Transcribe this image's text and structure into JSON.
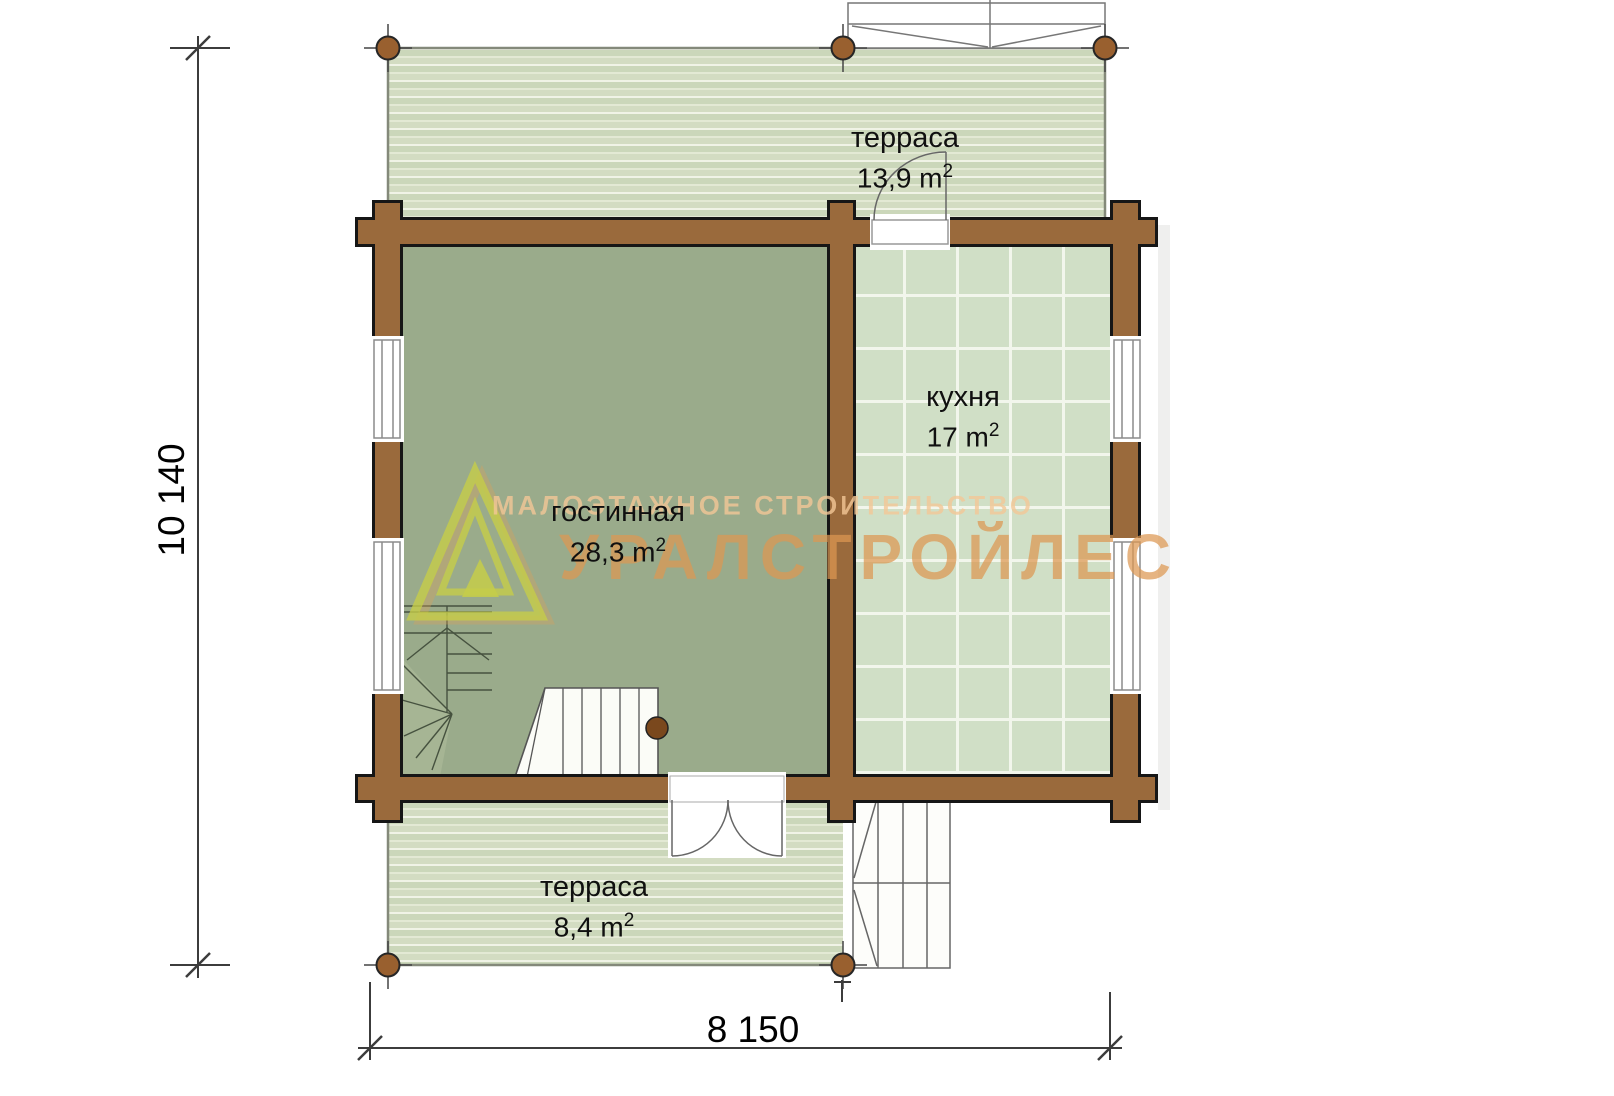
{
  "watermark": {
    "tagline": "МАЛОЭТАЖНОЕ СТРОИТЕЛЬСТВО",
    "brand": "УРАЛСТРОЙЛЕС"
  },
  "rooms": {
    "terrace_top": {
      "name": "терраса",
      "area": "13,9 m",
      "area_sup": "2"
    },
    "kitchen": {
      "name": "кухня",
      "area": "17 m",
      "area_sup": "2"
    },
    "living": {
      "name": "гостинная",
      "area": "28,3 m",
      "area_sup": "2"
    },
    "terrace_bottom": {
      "name": "терраса",
      "area": "8,4 m",
      "area_sup": "2"
    }
  },
  "dimensions": {
    "overall_height_mm": "10 140",
    "overall_width_mm": "8 150"
  },
  "colors": {
    "wall_brown": "#9a6a3c",
    "wall_outline": "#161616",
    "living_floor": "#9aab8b",
    "kitchen_tile": "#d0dfc6",
    "terrace_board": "#cbd7ba",
    "post_brown": "#99602f",
    "watermark_brand": "#dc9752",
    "logo_green": "#c5cd49"
  }
}
